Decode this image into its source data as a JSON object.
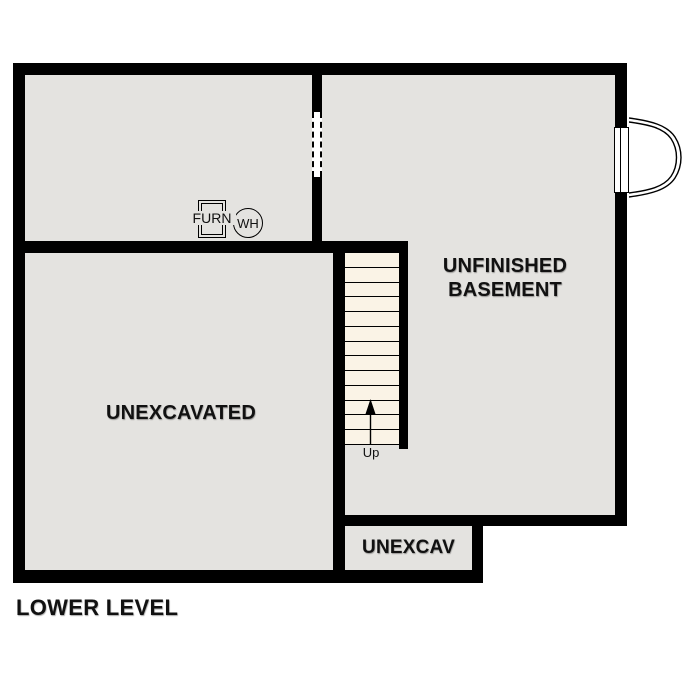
{
  "title": "LOWER LEVEL",
  "rooms": {
    "unfinished_basement": {
      "label_line1": "UNFINISHED",
      "label_line2": "BASEMENT"
    },
    "unexcavated": {
      "label": "UNEXCAVATED"
    },
    "unexcav_small": {
      "label": "UNEXCAV"
    }
  },
  "equipment": {
    "furnace": {
      "label": "FURN"
    },
    "water_heater": {
      "label": "WH"
    }
  },
  "stairs": {
    "direction_label": "Up",
    "tread_count": 13
  },
  "colors": {
    "wall": "#000000",
    "floor": "#e4e3e0",
    "stair_tread": "#faf3e6",
    "background": "#ffffff"
  }
}
